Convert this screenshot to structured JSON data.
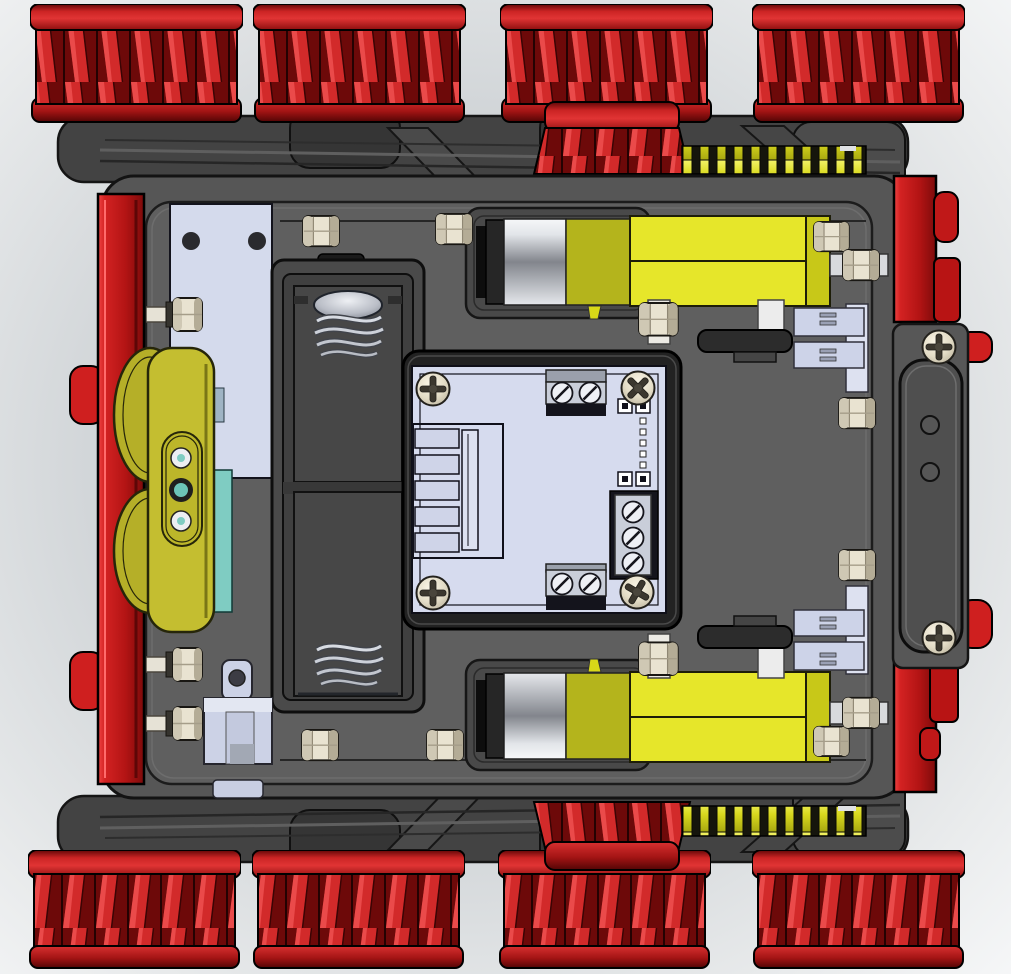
{
  "scene": {
    "title": "tracked-robot-chassis-cad-top-view",
    "render_style": "shaded-with-edges",
    "palette": {
      "background_light": "#f6f7f8",
      "background_mid": "#c9cdd1",
      "wheel_red_bright": "#d22a2a",
      "wheel_red_dark": "#6d0909",
      "side_plate_red": "#c81d1d",
      "chassis_gray": "#5b5b5b",
      "track_frame_gray": "#434343",
      "gear_yellow": "#d8d81e",
      "motor_yellow": "#e6e62a",
      "motor_silver": "#aeb1b7",
      "pcb_lavender": "#d6dbee",
      "hardware_lavender": "#ccd2e6",
      "terminal_gray": "#c9ced9",
      "bracket_olive": "#c4be30",
      "sensor_teal": "#7fccc2",
      "nut_beige": "#e9e3d1",
      "encoder_black": "#2c2c2c",
      "battery_holder_gray": "#404040",
      "spring_silver": "#d7dbe2"
    },
    "components": {
      "wheels": {
        "count": 8,
        "arrangement": "4 top edge, 4 bottom edge",
        "style": "finned red drums"
      },
      "drive_gears_red": {
        "count": 2,
        "position": "top center and bottom center"
      },
      "spur_gears_yellow": {
        "count": 2,
        "position": "meshed right of each red drive gear"
      },
      "gear_motors": {
        "count": 2,
        "body": "yellow gearbox with silver motor can"
      },
      "encoder_discs": {
        "count": 2
      },
      "encoder_sensor_brackets": {
        "count": 2
      },
      "battery_holder": {
        "cells_visible": 2,
        "springs": 2,
        "contact_dome": 1
      },
      "pcb": {
        "corner_screws": 4,
        "terminal_blocks": 3,
        "terminal_screws": 7,
        "pin_header_pads": 4,
        "edge_connector_slots": 5
      },
      "right_cover_panel": {
        "screws": 2,
        "holes": 2
      },
      "left_mount_plate": {
        "holes": 2
      },
      "olive_sensor_bracket": {
        "lenses": 3
      },
      "clevis_bracket": {
        "holes": 1
      },
      "hex_nuts_on_floor": 6,
      "side_bolts_left": 3
    }
  }
}
